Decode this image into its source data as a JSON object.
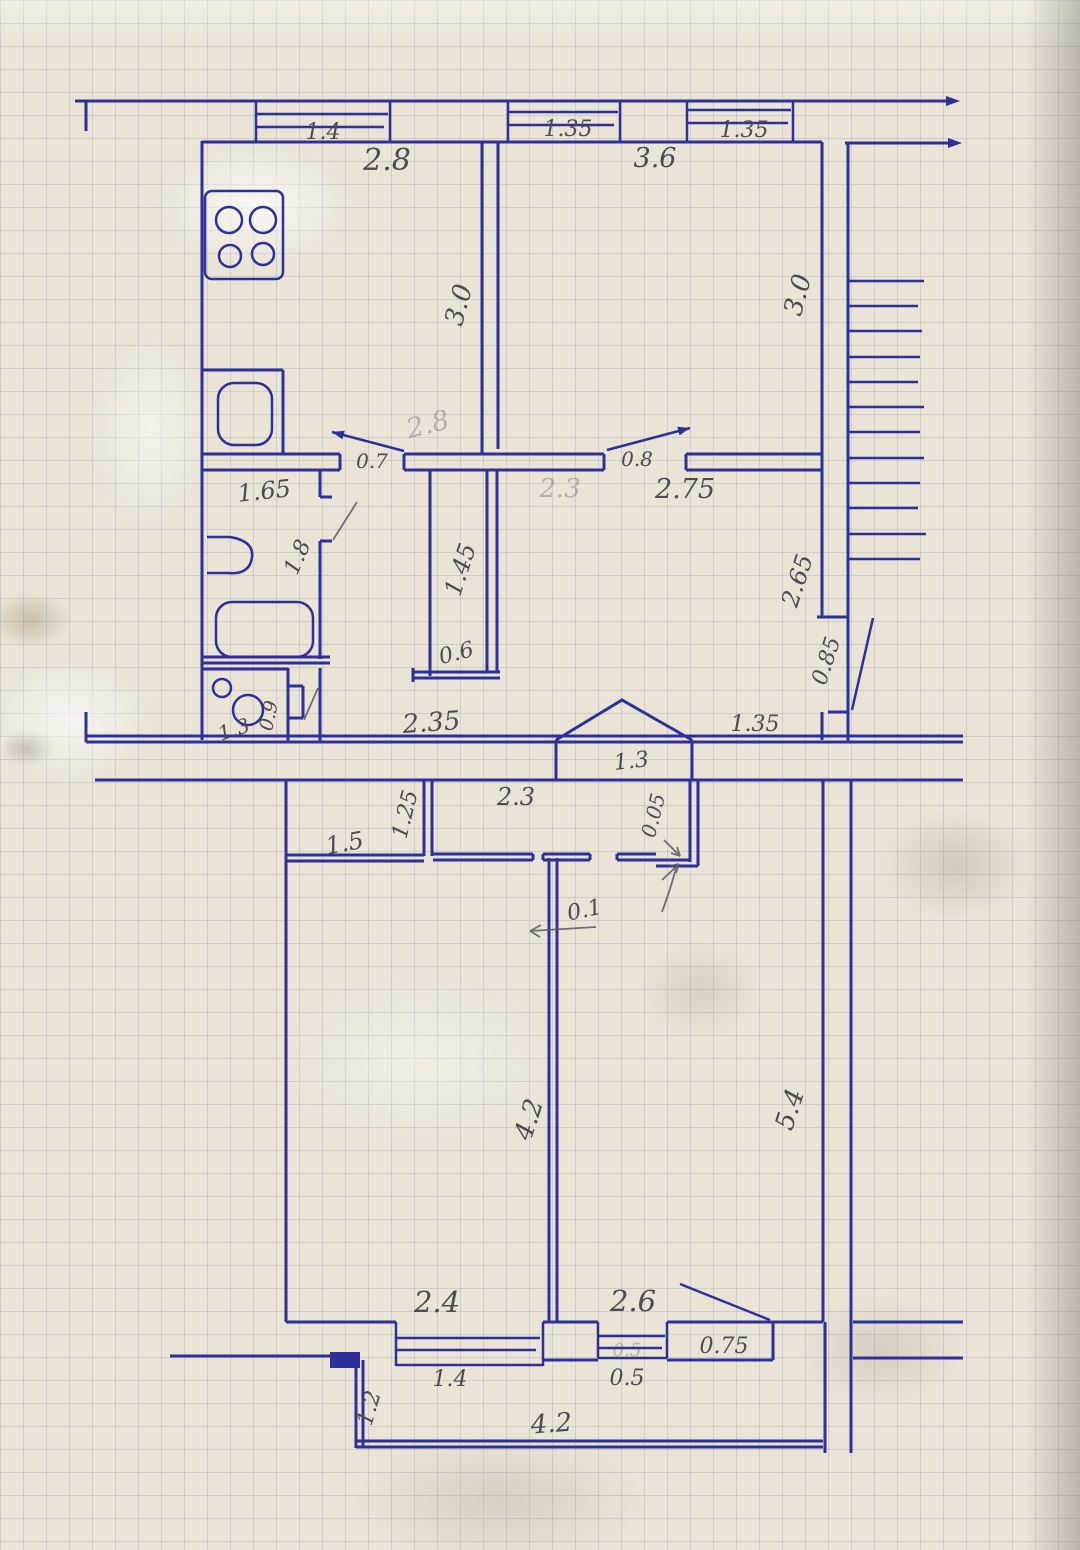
{
  "document": {
    "kind": "hand-drawn floor plan sketch",
    "medium": "blue ink on squared graph paper, pencil dimensions"
  },
  "colors": {
    "ink": "#2d2f9b",
    "pencil": "#4c4c50",
    "paper": "#e9e4d6"
  },
  "labels": {
    "win_top_1": "1.4",
    "kitchen_width": "2.8",
    "win_top_2": "1.35",
    "room2_width": "3.6",
    "win_top_3": "1.35",
    "kitchen_height": "3.0",
    "room2_height": "3.0",
    "kitchen_width_ghost": "2.8",
    "door_kitchen": "0.7",
    "door_room2": "0.8",
    "hall_width": "2.75",
    "hall_width_ghost": "2.3",
    "bath_width": "1.65",
    "bath_height": "1.8",
    "closet_height": "1.45",
    "closet_width": "0.6",
    "hall_right_height": "2.65",
    "door_right": "0.85",
    "wc_width": "1.3",
    "wc_depth": "0.9",
    "lower_wall_left": "2.35",
    "porch_width": "1.3",
    "win_mid_right": "1.35",
    "entry_left": "1.5",
    "entry_divider": "1.25",
    "entry_right": "2.3",
    "wall_gap": "0.05",
    "wall_thickness": "0.1",
    "room_left_height": "4.2",
    "room_right_height": "5.4",
    "room_left_width": "2.4",
    "room_right_width": "2.6",
    "door_balcony": "0.75",
    "win_bottom_1": "1.4",
    "win_bottom_2": "0.5",
    "win_bottom_2_ghost": "0.5",
    "balcony_depth": "1.2",
    "balcony_width": "4.2"
  }
}
